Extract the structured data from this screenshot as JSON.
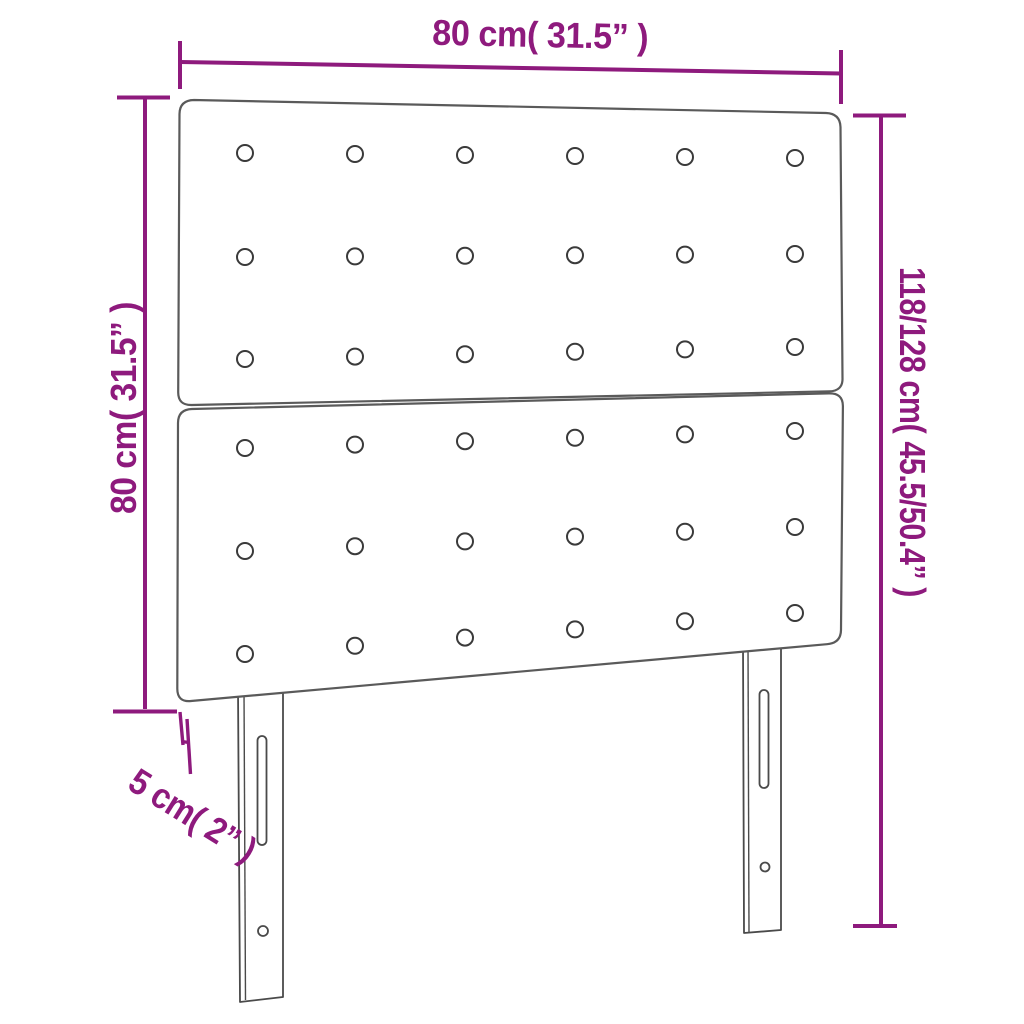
{
  "figure": {
    "background": "#ffffff",
    "accent_color": "#8E1A7D",
    "outline_color": "#5a5a5a",
    "labels": {
      "width_top": "80 cm( 31.5” )",
      "height_left": "80 cm( 31.5” )",
      "height_right": "118/128 cm( 45.5/50.4” )",
      "depth": "5 cm( 2” )"
    },
    "buttons": {
      "panel_count": 2,
      "rows_per_panel": 3,
      "columns": 6,
      "radius": 8,
      "columns_x": [
        245,
        355,
        465,
        575,
        685,
        795
      ],
      "rows_y": [
        {
          "left": 153,
          "right": 158
        },
        {
          "left": 257,
          "right": 254
        },
        {
          "left": 359,
          "right": 347
        },
        {
          "left": 448,
          "right": 431
        },
        {
          "left": 551,
          "right": 527
        },
        {
          "left": 654,
          "right": 613
        }
      ]
    }
  }
}
